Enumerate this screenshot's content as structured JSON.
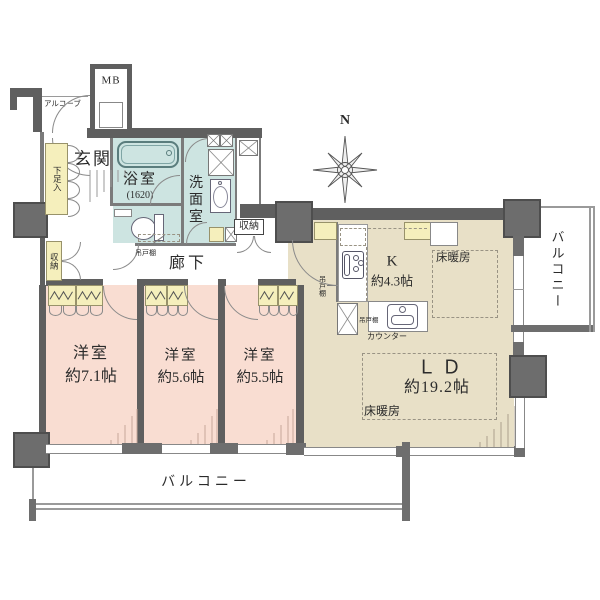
{
  "compass": {
    "north_label": "N"
  },
  "colors": {
    "wall": "#5f5f5f",
    "bedroom_floor": "#f9ddd2",
    "wet_area_floor": "#cde4e1",
    "living_floor": "#e8e0c7",
    "closet_fill": "#f5efbc",
    "line": "#777777"
  },
  "areas": {
    "alcove": {
      "label": "アルコーブ"
    },
    "meter_box": {
      "label": "MB"
    },
    "entrance": {
      "label": "玄関"
    },
    "shoe_cabinet": {
      "label": "下足入"
    },
    "bathroom": {
      "label": "浴室",
      "size_note": "(1620)"
    },
    "washroom": {
      "label": "洗面室"
    },
    "corridor": {
      "label": "廊下"
    },
    "storage_hall_left": {
      "label": "収納"
    },
    "storage_hall_top": {
      "label": "収納"
    },
    "kitchen": {
      "label": "K",
      "area": "約4.3帖"
    },
    "living_dining": {
      "label": "ＬＤ",
      "area": "約19.2帖"
    },
    "bedroom_1": {
      "label": "洋室",
      "area": "約7.1帖"
    },
    "bedroom_2": {
      "label": "洋室",
      "area": "約5.6帖"
    },
    "bedroom_3": {
      "label": "洋室",
      "area": "約5.5帖"
    },
    "balcony_south": {
      "label": "バルコニー"
    },
    "balcony_east": {
      "label": "バルコニー"
    }
  },
  "annotations": {
    "hanging_cupboard_corridor": {
      "label": "吊戸棚"
    },
    "hanging_cupboard_kitchen_entry": {
      "label": "吊戸棚"
    },
    "hanging_cupboard_kitchen_sink": {
      "label": "吊戸棚"
    },
    "kitchen_counter": {
      "label": "カウンター"
    },
    "floor_heating_kitchen": {
      "label": "床暖房"
    },
    "floor_heating_living": {
      "label": "床暖房"
    }
  }
}
